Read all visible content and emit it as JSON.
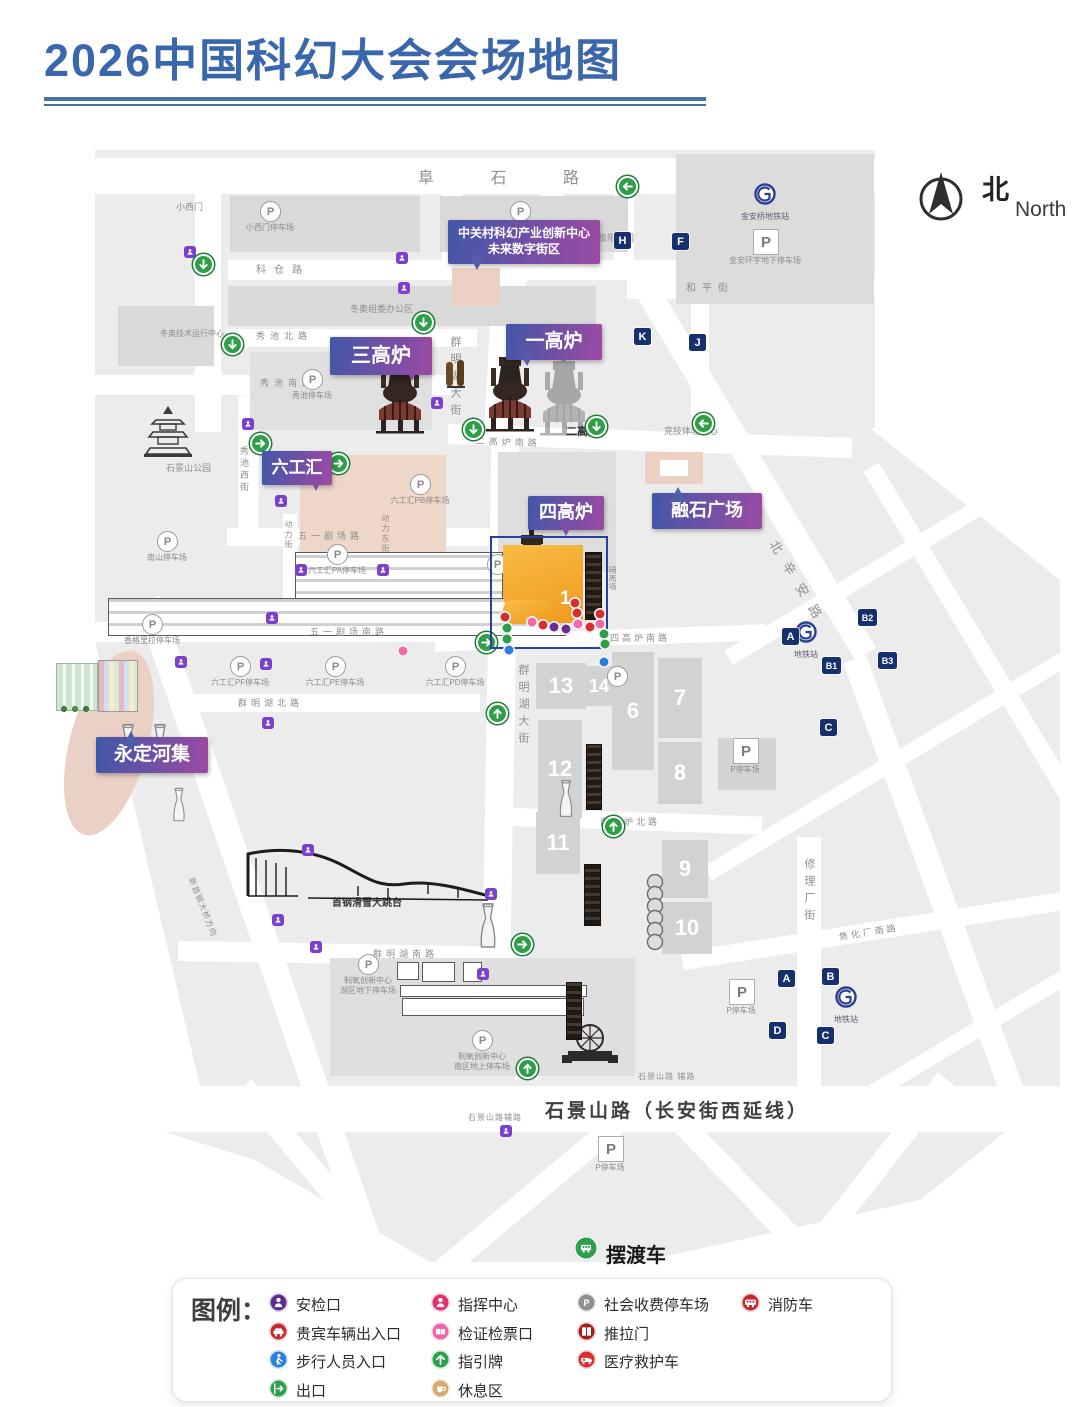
{
  "page": {
    "title": "2026中国科幻大会会场地图"
  },
  "north": {
    "zh": "北",
    "en": "North"
  },
  "shuttle": {
    "label": "摆渡车"
  },
  "colors": {
    "title_blue": "#3a67ab",
    "callout_gradient": [
      "#4157a8",
      "#9c4aa3"
    ],
    "map_gray": "#ececec",
    "building_gray": "#d9d9d9",
    "pink_building": "#ecd0c4",
    "zone_border_blue": "#2b3f9e",
    "zone_orange": "#f1991d",
    "marker_navy": "#16306e",
    "arrow_green": "#2f9e49",
    "security_purple": "#7a42cc",
    "dot_red": "#d3302f",
    "dot_pink": "#ef6aa8",
    "dot_purple": "#6a2d91",
    "dot_green": "#2f9e49",
    "dot_blue": "#2b7de0"
  },
  "venue_callouts": [
    {
      "lines": [
        "中关村科幻产业创新中心",
        "未来数字街区"
      ],
      "x": 448,
      "y": 220,
      "w": 152,
      "h": 44,
      "fs": 12,
      "tail": "bl"
    },
    {
      "lines": [
        "三高炉"
      ],
      "x": 330,
      "y": 337,
      "w": 102,
      "h": 38,
      "fs": 20,
      "tail": "br"
    },
    {
      "lines": [
        "一高炉"
      ],
      "x": 506,
      "y": 324,
      "w": 96,
      "h": 36,
      "fs": 19,
      "tail": "bl"
    },
    {
      "lines": [
        "六工汇"
      ],
      "x": 262,
      "y": 451,
      "w": 70,
      "h": 34,
      "fs": 17,
      "tail": "br"
    },
    {
      "lines": [
        "四高炉"
      ],
      "x": 528,
      "y": 496,
      "w": 76,
      "h": 34,
      "fs": 18,
      "tail": "b"
    },
    {
      "lines": [
        "融石广场"
      ],
      "x": 652,
      "y": 493,
      "w": 110,
      "h": 36,
      "fs": 18,
      "tail": "tl"
    },
    {
      "lines": [
        "永定河集"
      ],
      "x": 96,
      "y": 737,
      "w": 112,
      "h": 36,
      "fs": 19,
      "tail": "t"
    }
  ],
  "road_bars": [
    [
      485,
      176,
      790,
      36,
      0
    ],
    [
      208,
      312,
      240,
      26,
      90
    ],
    [
      508,
      270,
      560,
      20,
      0
    ],
    [
      752,
      288,
      250,
      22,
      0
    ],
    [
      452,
      228,
      72,
      20,
      90
    ],
    [
      624,
      234,
      80,
      20,
      90
    ],
    [
      700,
      362,
      132,
      18,
      90
    ],
    [
      352,
      338,
      250,
      18,
      0
    ],
    [
      272,
      385,
      358,
      20,
      0
    ],
    [
      650,
      441,
      404,
      20,
      2
    ],
    [
      532,
      242,
      112,
      24,
      115
    ],
    [
      501,
      360,
      148,
      26,
      93
    ],
    [
      501,
      695,
      536,
      28,
      91
    ],
    [
      527,
      1020,
      120,
      24,
      90
    ],
    [
      358,
      537,
      262,
      18,
      0
    ],
    [
      292,
      632,
      395,
      20,
      0
    ],
    [
      600,
      638,
      330,
      16,
      -2
    ],
    [
      330,
      703,
      300,
      18,
      0
    ],
    [
      628,
      821,
      268,
      18,
      2
    ],
    [
      352,
      954,
      348,
      20,
      1
    ],
    [
      545,
      1109,
      934,
      46,
      0
    ],
    [
      809,
      970,
      266,
      24,
      90
    ],
    [
      248,
      468,
      145,
      20,
      90
    ],
    [
      290,
      570,
      112,
      14,
      90
    ],
    [
      387,
      570,
      112,
      14,
      90
    ],
    [
      755,
      470,
      430,
      24,
      59
    ],
    [
      935,
      880,
      470,
      24,
      70
    ],
    [
      1005,
      690,
      520,
      18,
      59
    ],
    [
      900,
      555,
      400,
      16,
      -31
    ],
    [
      905,
      755,
      460,
      16,
      -31
    ],
    [
      880,
      930,
      400,
      18,
      -9
    ],
    [
      960,
      1040,
      260,
      16,
      -31
    ],
    [
      330,
      1190,
      270,
      22,
      50
    ],
    [
      520,
      1205,
      310,
      22,
      -40
    ],
    [
      748,
      1192,
      270,
      22,
      46
    ],
    [
      885,
      1158,
      200,
      22,
      -52
    ],
    [
      268,
      950,
      740,
      26,
      71
    ]
  ],
  "road_labels": [
    {
      "t": "阜 石 路",
      "x": 418,
      "y": 164,
      "fs": 16,
      "ls": 26
    },
    {
      "t": "科仓路",
      "x": 256,
      "y": 261,
      "fs": 10,
      "ls": 8
    },
    {
      "t": "和平街",
      "x": 686,
      "y": 279,
      "fs": 10,
      "ls": 6
    },
    {
      "t": "秀池北路",
      "x": 256,
      "y": 329,
      "fs": 9,
      "ls": 5
    },
    {
      "t": "秀池南路",
      "x": 260,
      "y": 376,
      "fs": 9,
      "ls": 5
    },
    {
      "t": "二高炉南路",
      "x": 476,
      "y": 434,
      "fs": 9,
      "ls": 4,
      "deg": 2
    },
    {
      "t": "群明湖大街",
      "x": 447,
      "y": 336,
      "fs": 11,
      "ls": 6,
      "vert": true
    },
    {
      "t": "群明湖大街",
      "x": 515,
      "y": 664,
      "fs": 11,
      "ls": 6,
      "vert": true
    },
    {
      "t": "五一剧场路",
      "x": 298,
      "y": 529,
      "fs": 9,
      "ls": 4
    },
    {
      "t": "五一剧场南路",
      "x": 310,
      "y": 625,
      "fs": 9,
      "ls": 4
    },
    {
      "t": "群明湖北路",
      "x": 238,
      "y": 696,
      "fs": 9,
      "ls": 4
    },
    {
      "t": "四高炉南路",
      "x": 610,
      "y": 631,
      "fs": 9,
      "ls": 3
    },
    {
      "t": "西焦炉北路",
      "x": 600,
      "y": 815,
      "fs": 9,
      "ls": 3
    },
    {
      "t": "群明湖南路",
      "x": 373,
      "y": 947,
      "fs": 9,
      "ls": 4
    },
    {
      "t": "焦化厂南路",
      "x": 838,
      "y": 930,
      "fs": 9,
      "ls": 3,
      "deg": -9
    },
    {
      "t": "修理厂街",
      "x": 801,
      "y": 858,
      "fs": 11,
      "ls": 6,
      "vert": true
    },
    {
      "t": "秀池西街",
      "x": 238,
      "y": 446,
      "fs": 9,
      "ls": 3,
      "vert": true
    },
    {
      "t": "动力街",
      "x": 283,
      "y": 520,
      "fs": 8,
      "ls": 2,
      "vert": true
    },
    {
      "t": "动力东街",
      "x": 380,
      "y": 514,
      "fs": 8,
      "ls": 2,
      "vert": true
    },
    {
      "t": "北辛安路",
      "x": 782,
      "y": 536,
      "fs": 13,
      "ls": 12,
      "deg": 59
    },
    {
      "t": "石景山路（长安街西延线）",
      "x": 545,
      "y": 1096,
      "fs": 19,
      "ls": 3,
      "bold": true,
      "dark": true
    },
    {
      "t": "石景山路 辅路",
      "x": 638,
      "y": 1071,
      "fs": 8,
      "ls": 1
    },
    {
      "t": "石景山路辅路",
      "x": 468,
      "y": 1112,
      "fs": 8,
      "ls": 1
    },
    {
      "t": "新首钢大桥方向",
      "x": 196,
      "y": 876,
      "fs": 8,
      "ls": 1,
      "deg": 68
    }
  ],
  "area_labels": [
    {
      "t": "小西门",
      "x": 176,
      "y": 200,
      "fs": 9
    },
    {
      "t": "冬奥组委办公区",
      "x": 350,
      "y": 302,
      "fs": 9
    },
    {
      "t": "冬奥技术运行中心",
      "x": 160,
      "y": 328,
      "fs": 8
    },
    {
      "t": "极限公园",
      "x": 598,
      "y": 231,
      "fs": 9
    },
    {
      "t": "石景山公园",
      "x": 166,
      "y": 461,
      "fs": 9
    },
    {
      "t": "二高炉",
      "x": 566,
      "y": 423,
      "fs": 11,
      "dark": true,
      "bold": true
    },
    {
      "t": "竞技体验中心",
      "x": 664,
      "y": 424,
      "fs": 9
    },
    {
      "t": "首钢滑雪大跳台",
      "x": 332,
      "y": 894,
      "fs": 10,
      "dark": true,
      "bold": true
    },
    {
      "t": "隔离墙",
      "x": 607,
      "y": 566,
      "fs": 8,
      "vert": true
    },
    {
      "t": "医疗",
      "x": 574,
      "y": 583,
      "fs": 7,
      "vert": true,
      "red": true
    }
  ],
  "numbered_blocks": [
    {
      "n": "13",
      "x": 536,
      "y": 663,
      "w": 50,
      "h": 46,
      "fs": 22
    },
    {
      "n": "14",
      "x": 586,
      "y": 666,
      "w": 26,
      "h": 40,
      "fs": 18
    },
    {
      "n": "6",
      "x": 612,
      "y": 652,
      "w": 42,
      "h": 118,
      "fs": 22
    },
    {
      "n": "7",
      "x": 658,
      "y": 658,
      "w": 44,
      "h": 80,
      "fs": 22
    },
    {
      "n": "12",
      "x": 538,
      "y": 720,
      "w": 44,
      "h": 98,
      "fs": 22
    },
    {
      "n": "8",
      "x": 658,
      "y": 742,
      "w": 44,
      "h": 62,
      "fs": 22
    },
    {
      "n": "11",
      "x": 536,
      "y": 812,
      "w": 44,
      "h": 62,
      "fs": 22
    },
    {
      "n": "9",
      "x": 662,
      "y": 840,
      "w": 46,
      "h": 58,
      "fs": 22
    },
    {
      "n": "10",
      "x": 662,
      "y": 902,
      "w": 50,
      "h": 52,
      "fs": 22
    }
  ],
  "zone": {
    "number": "1",
    "x": 490,
    "y": 536,
    "w": 114,
    "h": 109
  },
  "letter_markers": [
    [
      "H",
      614,
      232
    ],
    [
      "F",
      672,
      233
    ],
    [
      "K",
      634,
      328
    ],
    [
      "J",
      689,
      334
    ],
    [
      "A",
      782,
      628
    ],
    [
      "B2",
      858,
      609
    ],
    [
      "B1",
      822,
      657
    ],
    [
      "B3",
      878,
      652
    ],
    [
      "C",
      820,
      719
    ],
    [
      "A",
      778,
      970
    ],
    [
      "B",
      822,
      968
    ],
    [
      "D",
      769,
      1022
    ],
    [
      "C",
      817,
      1027
    ]
  ],
  "green_arrows": [
    [
      627,
      186,
      "left"
    ],
    [
      423,
      322,
      "down"
    ],
    [
      203,
      264,
      "down"
    ],
    [
      232,
      344,
      "down"
    ],
    [
      260,
      443,
      "right"
    ],
    [
      338,
      463,
      "right"
    ],
    [
      473,
      429,
      "down"
    ],
    [
      596,
      426,
      "down"
    ],
    [
      703,
      423,
      "left"
    ],
    [
      486,
      642,
      "right"
    ],
    [
      497,
      713,
      "up"
    ],
    [
      613,
      826,
      "up"
    ],
    [
      522,
      944,
      "right"
    ],
    [
      527,
      1068,
      "up"
    ]
  ],
  "security_markers": [
    [
      184,
      246
    ],
    [
      396,
      252
    ],
    [
      398,
      282
    ],
    [
      431,
      397
    ],
    [
      242,
      418
    ],
    [
      275,
      495
    ],
    [
      295,
      564
    ],
    [
      377,
      564
    ],
    [
      266,
      612
    ],
    [
      175,
      656
    ],
    [
      260,
      658
    ],
    [
      262,
      717
    ],
    [
      302,
      844
    ],
    [
      272,
      914
    ],
    [
      310,
      941
    ],
    [
      485,
      888
    ],
    [
      477,
      968
    ],
    [
      500,
      1125
    ]
  ],
  "zone_dots": [
    [
      505,
      617,
      "red"
    ],
    [
      507,
      628,
      "green"
    ],
    [
      507,
      639,
      "green"
    ],
    [
      509,
      650,
      "blue"
    ],
    [
      532,
      622,
      "pink"
    ],
    [
      543,
      625,
      "red"
    ],
    [
      554,
      627,
      "purple"
    ],
    [
      566,
      629,
      "purple"
    ],
    [
      578,
      624,
      "pink"
    ],
    [
      590,
      627,
      "red"
    ],
    [
      600,
      614,
      "red"
    ],
    [
      600,
      624,
      "pink"
    ],
    [
      604,
      634,
      "green"
    ],
    [
      605,
      644,
      "green"
    ],
    [
      604,
      662,
      "blue"
    ],
    [
      575,
      603,
      "red"
    ],
    [
      577,
      613,
      "red"
    ],
    [
      403,
      651,
      "pink"
    ]
  ],
  "parkings_ring": [
    [
      270,
      211,
      "小西门停车场"
    ],
    [
      520,
      211,
      "西十冬奥广场停车场"
    ],
    [
      312,
      379,
      "秀池停车场"
    ],
    [
      420,
      484,
      "六工汇PB停车场"
    ],
    [
      337,
      554,
      "六工汇PA停车场"
    ],
    [
      167,
      541,
      "南山停车场"
    ],
    [
      152,
      624,
      "香格里拉停车场"
    ],
    [
      240,
      666,
      "六工汇PF停车场"
    ],
    [
      335,
      666,
      "六工汇PE停车场"
    ],
    [
      455,
      666,
      "六工汇PD停车场"
    ],
    [
      617,
      676,
      ""
    ],
    [
      497,
      564,
      ""
    ],
    [
      368,
      964,
      "制氧创新中心|湖区地下停车场"
    ],
    [
      482,
      1040,
      "制氧创新中心|南区地上停车场"
    ]
  ],
  "parkings_boxed": [
    [
      765,
      241,
      "金安环宇地下停车场"
    ],
    [
      745,
      750,
      "P停车场"
    ],
    [
      741,
      991,
      "P停车场"
    ],
    [
      610,
      1148,
      "P停车场"
    ]
  ],
  "metro_stations": [
    [
      765,
      194,
      "金安桥地铁站"
    ],
    [
      806,
      632,
      "地铁站"
    ],
    [
      846,
      997,
      "地铁站"
    ]
  ],
  "legend": {
    "title": "图例：",
    "columns": [
      [
        {
          "label": "安检口",
          "color": "#5b2b8f",
          "glyph": "person"
        },
        {
          "label": "贵宾车辆出入口",
          "color": "#c62a33",
          "glyph": "car"
        },
        {
          "label": "步行人员入口",
          "color": "#2a7ede",
          "glyph": "walker"
        },
        {
          "label": "出口",
          "color": "#2e9e4f",
          "glyph": "exit"
        }
      ],
      [
        {
          "label": "指挥中心",
          "color": "#e0336e",
          "glyph": "person"
        },
        {
          "label": "检证检票口",
          "color": "#ee66a6",
          "glyph": "ticket"
        },
        {
          "label": "指引牌",
          "color": "#2e9e4f",
          "glyph": "arrow"
        },
        {
          "label": "休息区",
          "color": "#d9aa6d",
          "glyph": "rest"
        }
      ],
      [
        {
          "label": "社会收费停车场",
          "color": "#8f8f8f",
          "glyph": "parking"
        },
        {
          "label": "推拉门",
          "color": "#a51c1c",
          "glyph": "door"
        },
        {
          "label": "医疗救护车",
          "color": "#d3302f",
          "glyph": "ambulance"
        }
      ],
      [
        {
          "label": "消防车",
          "color": "#c1272d",
          "glyph": "firetruck"
        }
      ]
    ]
  }
}
